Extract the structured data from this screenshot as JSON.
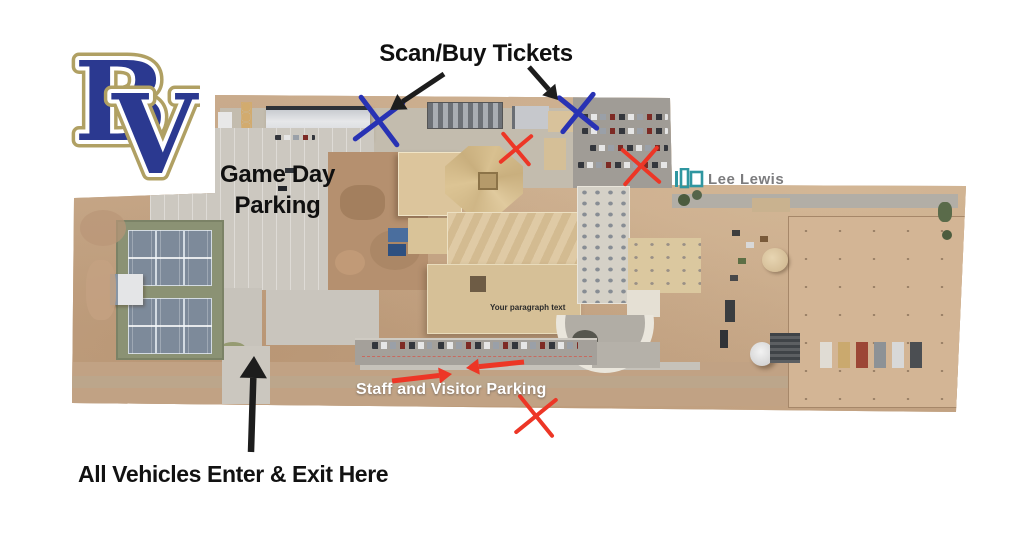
{
  "annotations": {
    "scan_buy_tickets": "Scan/Buy Tickets",
    "game_day_parking": "Game Day\nParking",
    "staff_visitor_parking": "Staff and Visitor Parking",
    "all_vehicles_enter_exit": "All Vehicles Enter & Exit Here",
    "placeholder_text": "Your paragraph text",
    "lee_lewis": "Lee Lewis"
  },
  "logo": {
    "letter_b": "B",
    "letter_v": "V",
    "fill": "#2b3990",
    "inner_outline": "#ffffff",
    "outer_outline": "#b0a063"
  },
  "colors": {
    "marker_blue": "#2832b4",
    "marker_red": "#ed3626",
    "arrow_black": "#1d1d1d",
    "lee_lewis_teal": "#2f96a0",
    "staff_label_white": "#ffffff"
  },
  "markers": [
    {
      "name": "ticket-scan-x-west",
      "type": "x",
      "x": 379,
      "y": 121,
      "size": 42,
      "color": "#2832b4",
      "stroke": 5,
      "rotate": 8
    },
    {
      "name": "ticket-scan-x-east",
      "type": "x",
      "x": 578,
      "y": 113,
      "size": 34,
      "color": "#2832b4",
      "stroke": 5,
      "rotate": -6
    },
    {
      "name": "closed-x-north",
      "type": "x",
      "x": 516,
      "y": 149,
      "size": 28,
      "color": "#ed3626",
      "stroke": 4,
      "rotate": 5
    },
    {
      "name": "closed-x-east",
      "type": "x",
      "x": 641,
      "y": 166,
      "size": 34,
      "color": "#ed3626",
      "stroke": 4,
      "rotate": -4
    },
    {
      "name": "closed-x-south",
      "type": "x",
      "x": 536,
      "y": 416,
      "size": 36,
      "color": "#ed3626",
      "stroke": 4,
      "rotate": 6
    },
    {
      "name": "ticket-arrow-west",
      "type": "arrow",
      "x1": 444,
      "y1": 74,
      "x2": 390,
      "y2": 110,
      "color": "#1d1d1d",
      "width": 5,
      "head": 15
    },
    {
      "name": "ticket-arrow-east",
      "type": "arrow",
      "x1": 529,
      "y1": 67,
      "x2": 558,
      "y2": 100,
      "color": "#1d1d1d",
      "width": 5,
      "head": 14
    },
    {
      "name": "enter-exit-arrow",
      "type": "arrow",
      "x1": 251,
      "y1": 452,
      "x2": 254,
      "y2": 356,
      "color": "#1d1d1d",
      "width": 6.5,
      "head": 22
    },
    {
      "name": "staff-arrow-right",
      "type": "arrow",
      "x1": 392,
      "y1": 381,
      "x2": 452,
      "y2": 374,
      "color": "#ed3626",
      "width": 5,
      "head": 13
    },
    {
      "name": "staff-arrow-left",
      "type": "arrow",
      "x1": 524,
      "y1": 362,
      "x2": 466,
      "y2": 368,
      "color": "#ed3626",
      "width": 5,
      "head": 13
    }
  ]
}
